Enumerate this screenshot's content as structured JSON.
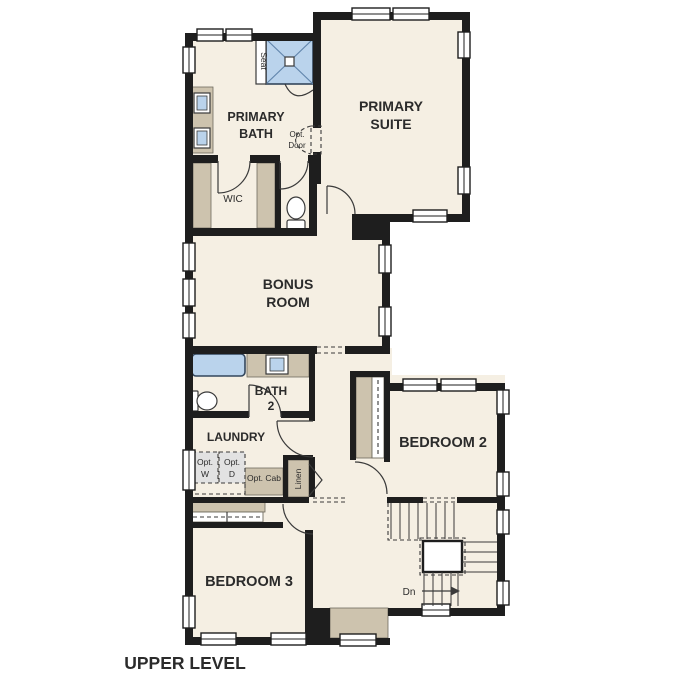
{
  "colors": {
    "floor": "#f5efe3",
    "wall": "#1e1e1e",
    "tan": "#cdc3ae",
    "tan_edge": "#6f6a5e",
    "fixture_blue": "#bad3ec",
    "fixture_dark": "#33465c",
    "shower_line": "#6286ad",
    "opt_gray": "#e2e2e2",
    "line": "#3a3a3a",
    "text": "#2b2b2b"
  },
  "rooms": {
    "primary_suite": {
      "line1": "PRIMARY",
      "line2": "SUITE"
    },
    "primary_bath": {
      "line1": "PRIMARY",
      "line2": "BATH"
    },
    "bonus_room": {
      "line1": "BONUS",
      "line2": "ROOM"
    },
    "bath2": {
      "line1": "BATH",
      "line2": "2"
    },
    "laundry": {
      "label": "LAUNDRY"
    },
    "bedroom2": {
      "label": "BEDROOM 2"
    },
    "bedroom3": {
      "label": "BEDROOM 3"
    },
    "wic": {
      "label": "WIC"
    }
  },
  "annotations": {
    "seat": "Seat",
    "linen": "Linen",
    "opt_door_line1": "Opt.",
    "opt_door_line2": "Door",
    "opt_washer_line1": "Opt.",
    "opt_washer_line2": "W",
    "opt_dryer_line1": "Opt.",
    "opt_dryer_line2": "D",
    "opt_cab": "Opt. Cab",
    "down": "Dn"
  },
  "footer": {
    "plan_label": "UPPER LEVEL"
  }
}
